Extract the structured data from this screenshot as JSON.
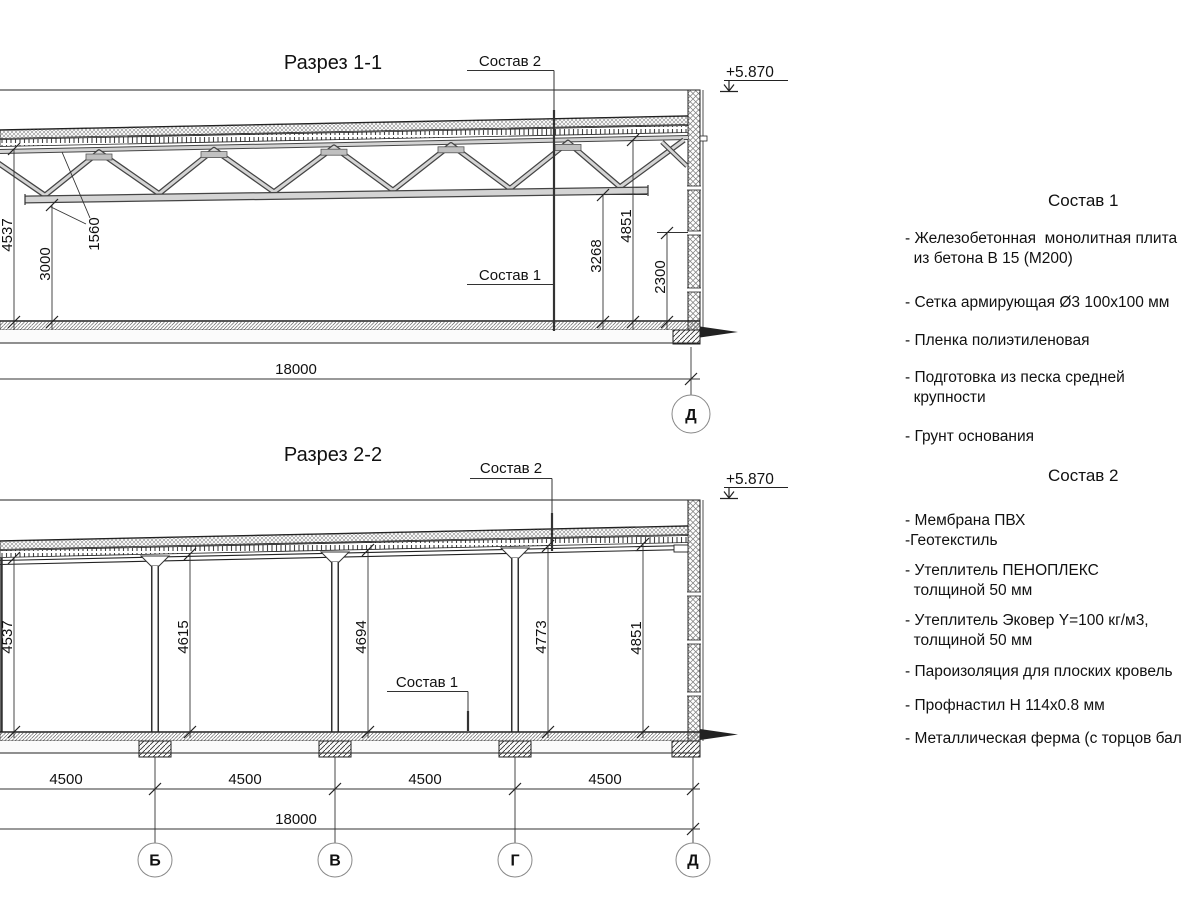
{
  "section1": {
    "title": "Разрез 1-1",
    "callout_top": "Состав 2",
    "callout_bottom": "Состав 1",
    "elevation": "+5.870",
    "dim_height_left": "4537",
    "dim_truss_depth": "1560",
    "dim_clear_height": "3000",
    "dim_under_truss": "3268",
    "dim_height_right": "4851",
    "dim_wall_base": "2300",
    "dim_total": "18000",
    "axis": "Д"
  },
  "section2": {
    "title": "Разрез 2-2",
    "callout_top": "Состав 2",
    "callout_bottom": "Состав 1",
    "elevation": "+5.870",
    "dim_heights": [
      "4537",
      "4615",
      "4694",
      "4773",
      "4851"
    ],
    "dim_spans": [
      "4500",
      "4500",
      "4500",
      "4500"
    ],
    "dim_total": "18000",
    "axes": [
      "Б",
      "В",
      "Г",
      "Д"
    ]
  },
  "materials1": {
    "title": "Состав 1",
    "items": [
      "- Железобетонная  монолитная плита\n  из бетона В 15 (М200)",
      "- Сетка армирующая Ø3 100х100 мм",
      "- Пленка полиэтиленовая",
      "- Подготовка из песка средней\n  крупности",
      "- Грунт основания"
    ]
  },
  "materials2": {
    "title": "Состав 2",
    "items": [
      "- Мембрана ПВХ\n-Геотекстиль",
      "- Утеплитель ПЕНОПЛЕКС\n  толщиной 50 мм",
      "- Утеплитель Эковер Y=100 кг/м3,\n  толщиной 50 мм",
      "- Пароизоляция для плоских кровель",
      "- Профнастил Н 114х0.8 мм",
      "- Металлическая ферма (с торцов бал"
    ]
  }
}
